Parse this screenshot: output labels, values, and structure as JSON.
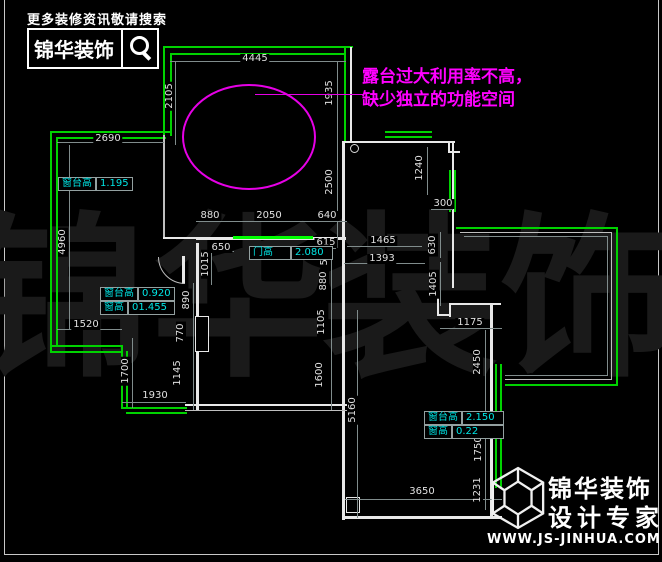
{
  "header": {
    "tagline": "更多装修资讯敬请搜索",
    "brand": "锦华装饰"
  },
  "annotation": {
    "line1": "露台过大利用率不高，",
    "line2": "缺少独立的功能空间"
  },
  "watermark": {
    "c1": "锦",
    "c2": "华",
    "c3": "装",
    "c4": "饰"
  },
  "footer": {
    "brand": "锦华装饰",
    "tagline": "设计专家",
    "url": "WWW.JS-JINHUA.COM"
  },
  "colors": {
    "window_green": "#00d200",
    "door_bright_green": "#00ff00",
    "annotation_magenta": "#ff00ff",
    "label_cyan": "#00e6e6"
  },
  "info_boxes": {
    "sill1": {
      "label": "窗台高",
      "value": "1.195"
    },
    "sill2": {
      "label": "窗台高",
      "value": "0.920"
    },
    "win2": {
      "label": "窗高",
      "value": "01.455"
    },
    "door": {
      "label": "门高",
      "value": "2.080"
    },
    "sill3": {
      "label": "窗台高",
      "value": "2.150"
    },
    "win3": {
      "label": "窗高",
      "value": "0.22"
    }
  },
  "dims": {
    "d4445": "4445",
    "d2690": "2690",
    "d880a": "880",
    "d2050": "2050",
    "d640": "640",
    "d650": "650",
    "d615": "615",
    "d1465": "1465",
    "d1393": "1393",
    "d300": "300",
    "d1175": "1175",
    "d1520": "1520",
    "d1930": "1930",
    "d3650": "3650",
    "d2105": "2105",
    "d1935": "1935",
    "d2500": "2500",
    "d4960": "4960",
    "d1240": "1240",
    "d1015": "1015",
    "d890": "890",
    "d770": "770",
    "d1145": "1145",
    "d505": "505",
    "d880b": "880",
    "d1105": "1105",
    "d1600": "1600",
    "d5160": "5160",
    "d630": "630",
    "d1405": "1405",
    "d2450": "2450",
    "d1750": "1750",
    "d1231": "1231",
    "d1700": "1700"
  }
}
